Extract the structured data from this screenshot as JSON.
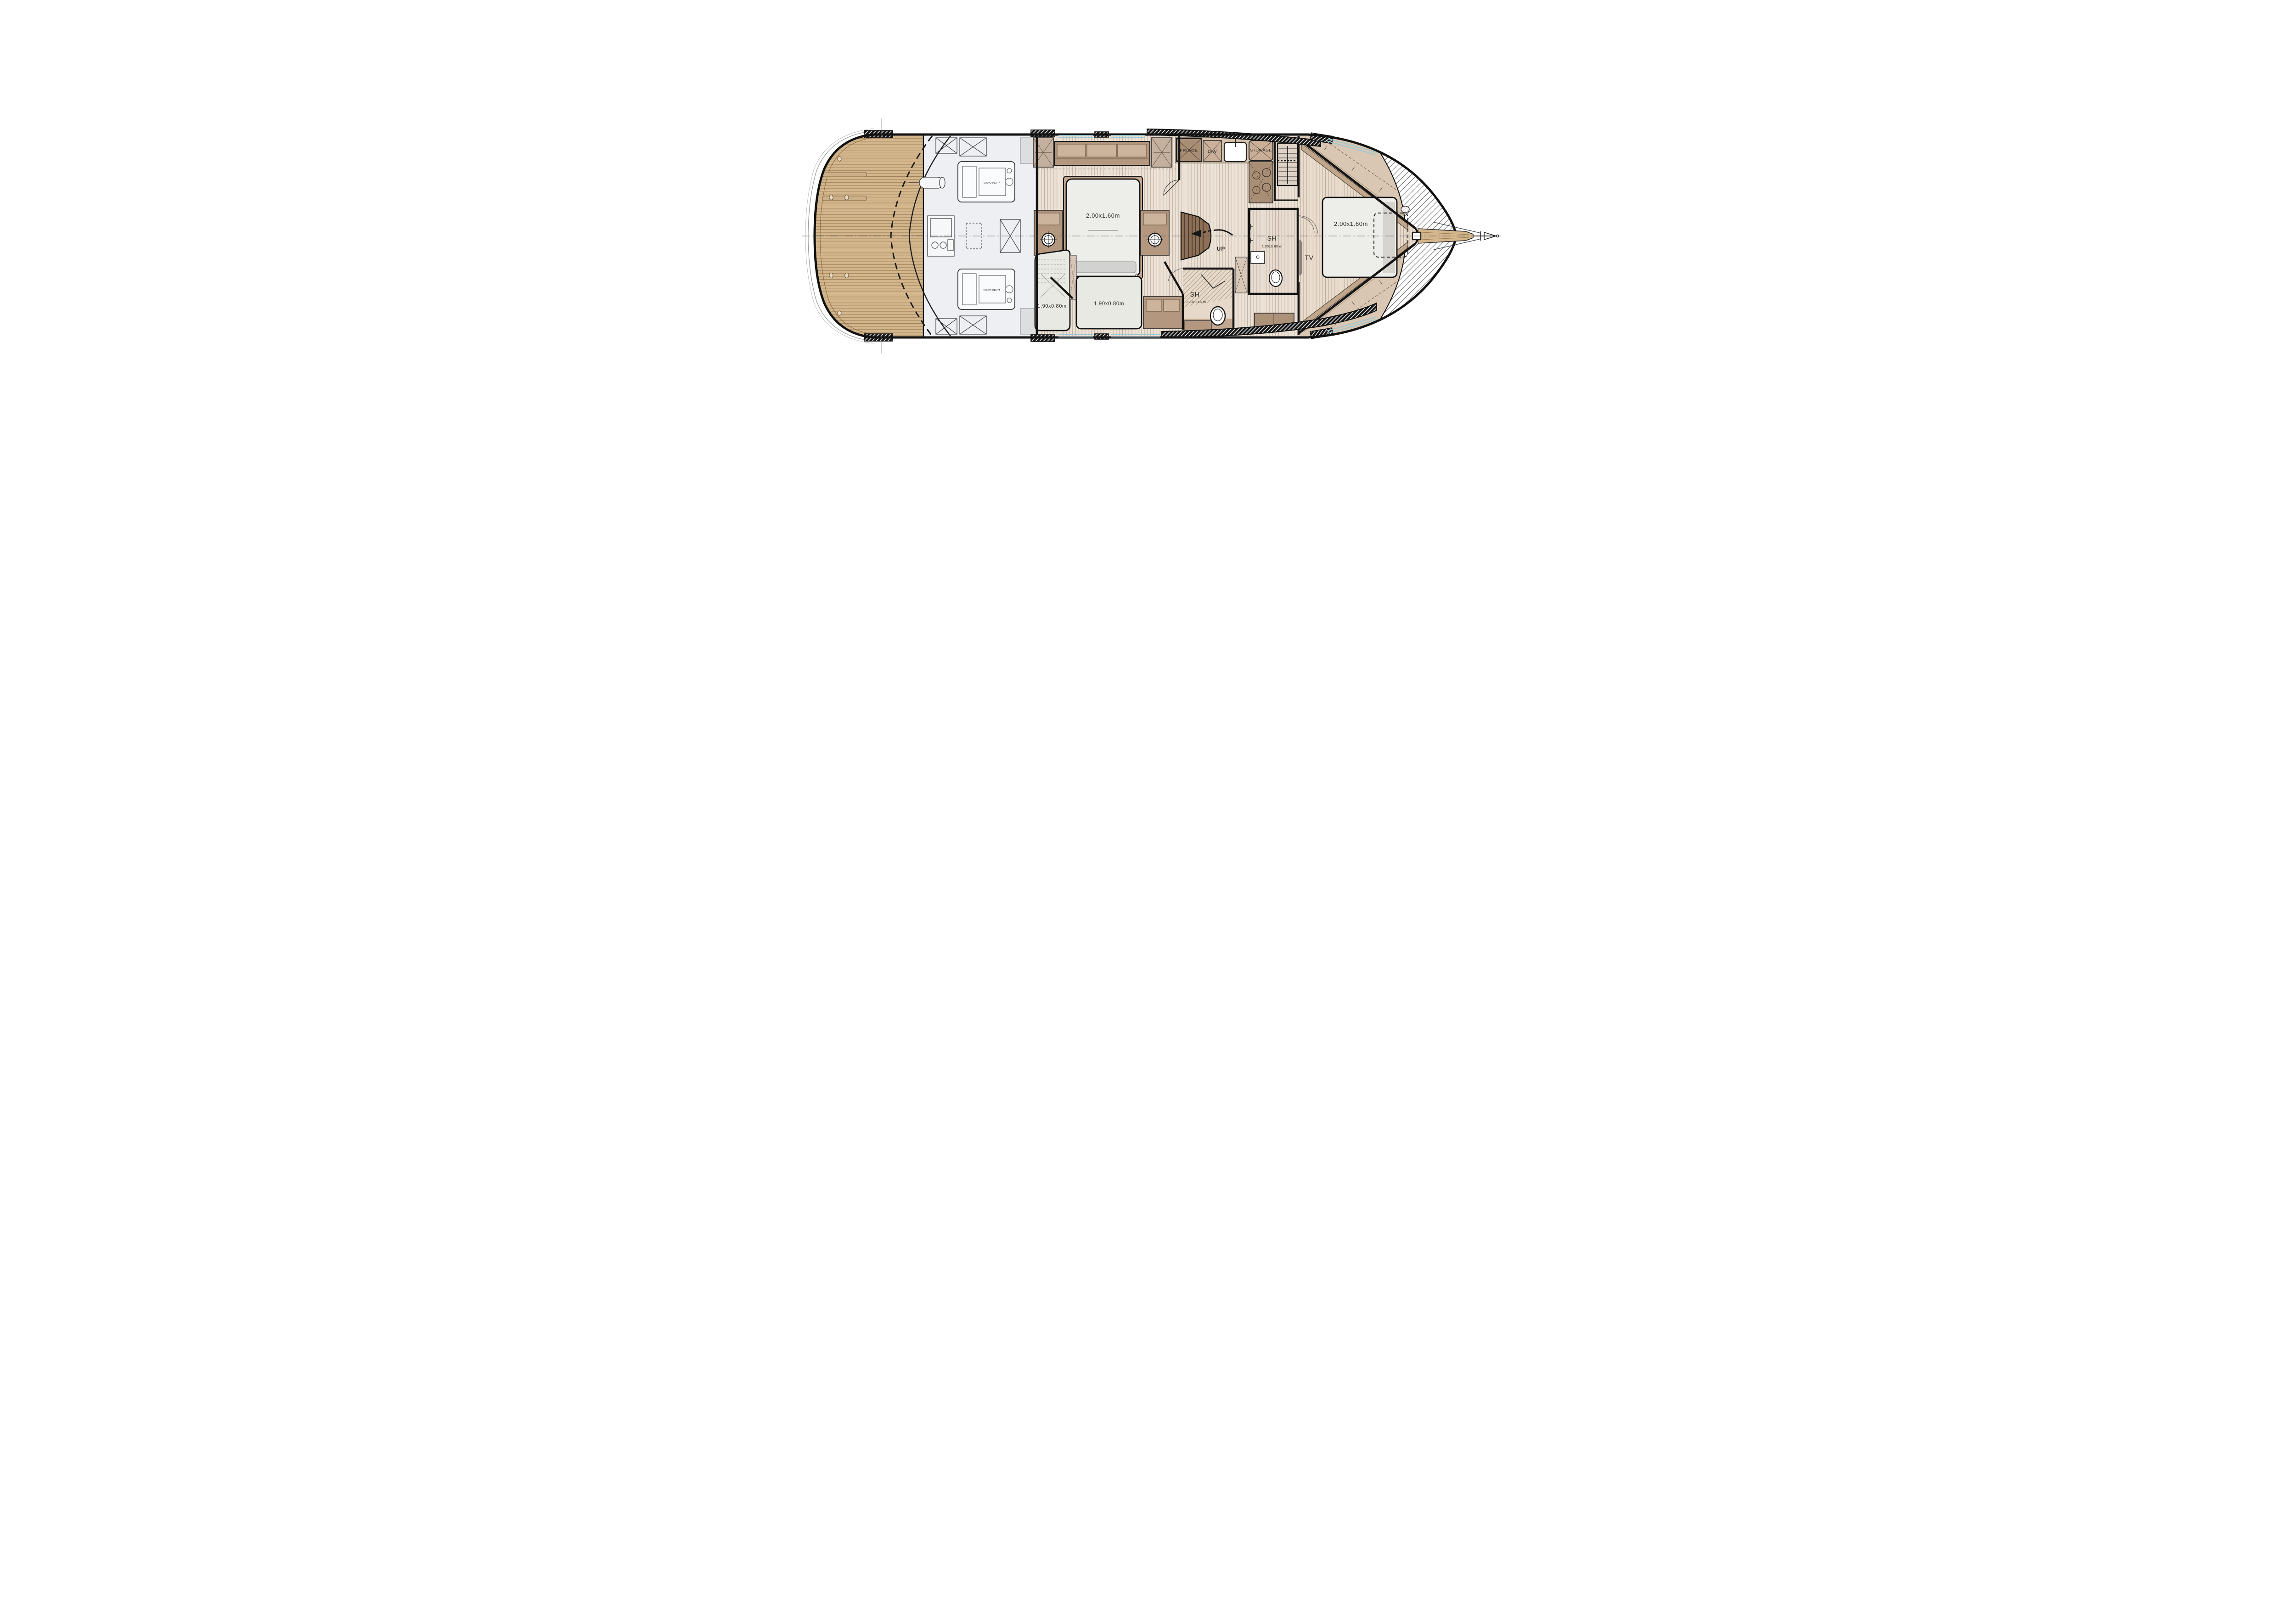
{
  "labels": {
    "fridge": "FRIDGE",
    "dishwasher": "D/W",
    "stowage": "STOWAGE",
    "shower_fwd": "SH",
    "shower_fwd_dims": "1.00x0.65 m",
    "shower_aft": "SH",
    "shower_aft_dims": "0.90x0.65 m",
    "tv": "TV",
    "stairs_up": "UP",
    "master_bed_dims": "2.00x1.60m",
    "vip_bed_dims": "2.00x1.60m",
    "guest_bed_outboard_dims": "1.90x0.80m",
    "guest_bed_inboard_dims": "1.90x0.80m",
    "engine_port": "VOLVO PENTA",
    "engine_starboard": "VOLVO PENTA"
  },
  "colors": {
    "teak_deck": "#d3b68c",
    "floor_plank": "#ece1d5",
    "floor_vip": "#e9dccd",
    "furniture_brown": "#b3987f",
    "furniture_panel": "#ccb49c",
    "counter": "#d7c2ab",
    "fridge_box": "#a98e76",
    "stairs_brown": "#8d6f56",
    "engine_room_bg": "#edeff2",
    "window_blue": "#9cc7d4",
    "wall_black": "#141414",
    "bed_white": "#edeeea",
    "side_deck_tan": "#d9c7b3"
  }
}
